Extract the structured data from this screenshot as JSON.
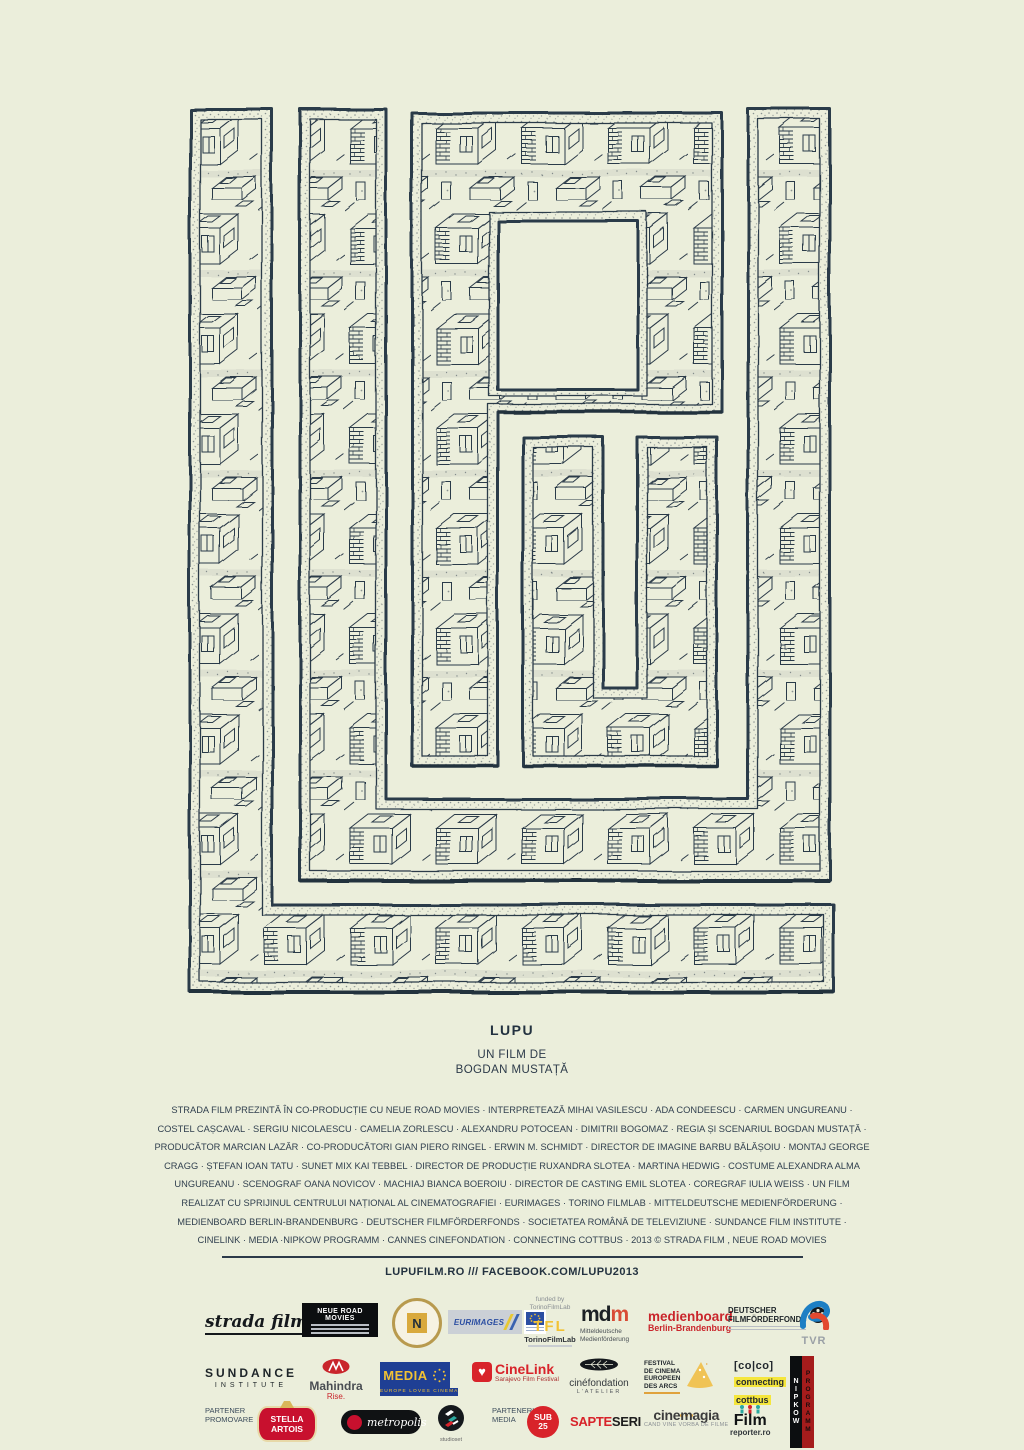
{
  "artwork": {
    "letters": "LUPU"
  },
  "title_block": {
    "title": "LUPU",
    "byline_line1": "UN FILM DE",
    "byline_line2": "BOGDAN MUSTAȚĂ"
  },
  "credits": {
    "lines": [
      "STRADA FILM PREZINTĂ ÎN CO-PRODUCȚIE CU NEUE ROAD MOVIES · INTERPRETEAZĂ MIHAI VASILESCU · ADA CONDEESCU · CARMEN UNGUREANU ·",
      "COSTEL CAȘCAVAL · SERGIU NICOLAESCU · CAMELIA ZORLESCU · ALEXANDRU POTOCEAN · DIMITRII BOGOMAZ · REGIA ȘI SCENARIUL BOGDAN MUSTAȚĂ ·",
      "PRODUCĂTOR MARCIAN LAZĂR · CO-PRODUCĂTORI GIAN PIERO RINGEL · ERWIN M. SCHMIDT · DIRECTOR DE IMAGINE BARBU BĂLĂȘOIU · MONTAJ GEORGE",
      "CRAGG · ȘTEFAN IOAN TATU · SUNET MIX KAI TEBBEL · DIRECTOR DE PRODUCȚIE RUXANDRA SLOTEA · MARTINA HEDWIG · COSTUME ALEXANDRA ALMA",
      "UNGUREANU · SCENOGRAF OANA NOVICOV · MACHIAJ BIANCA BOEROIU · DIRECTOR DE CASTING EMIL SLOTEA · COREGRAF IULIA WEISS · UN FILM",
      "REALIZAT CU SPRIJINUL CENTRULUI NAȚIONAL AL CINEMATOGRAFIEI · EURIMAGES · TORINO FILMLAB · MITTELDEUTSCHE MEDIENFÖRDERUNG ·",
      "MEDIENBOARD BERLIN-BRANDENBURG · DEUTSCHER FILMFÖRDERFONDS · SOCIETATEA ROMÂNĂ DE TELEVIZIUNE · SUNDANCE FILM INSTITUTE ·",
      "CINELINK · MEDIA ·NIPKOW PROGRAMM · CANNES CINEFONDATION · CONNECTING COTTBUS · 2013 © STRADA FILM , NEUE ROAD MOVIES"
    ]
  },
  "links_bar": {
    "text": "LUPUFILM.RO  ///  FACEBOOK.COM/LUPU2013"
  },
  "partners": {
    "strada_film": {
      "name": "strada film"
    },
    "neue_road_movies": {
      "name": "NEUE ROAD MOVIES"
    },
    "cnc": {
      "letter": "N"
    },
    "eurimages": {
      "name": "EURIMAGES"
    },
    "torino": {
      "funded_by": "funded by",
      "funded_org": "TorinoFilmLab",
      "acronym": "TFL",
      "name": "TorinoFilmLab"
    },
    "mdm": {
      "m1": "m",
      "d": "d",
      "m2": "m",
      "line1": "Mitteldeutsche",
      "line2": "Medienförderung"
    },
    "medienboard": {
      "name": "medienboard",
      "region": "Berlin-Brandenburg"
    },
    "dfff": {
      "line1": "DEUTSCHER",
      "line2": "FILMFÖRDERFONDS"
    },
    "tvr": {
      "name": "TVR"
    },
    "sundance": {
      "line1": "SUNDANCE",
      "line2": "INSTITUTE"
    },
    "mahindra": {
      "name": "Mahindra",
      "tagline": "Rise."
    },
    "media_programme": {
      "name": "MEDIA",
      "tagline": "EUROPE LOVES CINEMA"
    },
    "cinelink": {
      "heart": "♥",
      "name": "CineLink",
      "subtitle": "Sarajevo Film Festival"
    },
    "cinefondation": {
      "name": "cinéfondation",
      "subtitle": "L'ATELIER"
    },
    "les_arcs": {
      "line1": "FESTIVAL",
      "line2": "DE CINEMA",
      "line3": "EUROPEEN",
      "line4": "DES ARCS"
    },
    "coco": {
      "mark": "[co|co]",
      "line1": "connecting",
      "line2": "cottbus"
    },
    "nipkow": {
      "word1": "NIPKOW",
      "word2": "PROGRAMM"
    },
    "labels": {
      "promo_line1": "PARTENER",
      "promo_line2": "PROMOVARE",
      "media_line1": "PARTENERI",
      "media_line2": "MEDIA"
    },
    "stella": {
      "line1": "STELLA",
      "line2": "ARTOIS"
    },
    "metropolis": {
      "name": "metropolis"
    },
    "studioset": {
      "name": "studioset"
    },
    "sub25": {
      "line1": "SUB",
      "line2": "25"
    },
    "sapteseri": {
      "part1": "SAPTE",
      "part2": "SERI"
    },
    "cinemagia": {
      "name": "cinemagia",
      "tagline": "CAND VINE VORBA DE FILME"
    },
    "filmreporter": {
      "name": "Film",
      "subtitle": "reporter.ro"
    }
  },
  "colors": {
    "background": "#ebeedb",
    "ink": "#2c3a49",
    "accent_red": "#c9252b",
    "accent_yellow": "#f2c233"
  }
}
